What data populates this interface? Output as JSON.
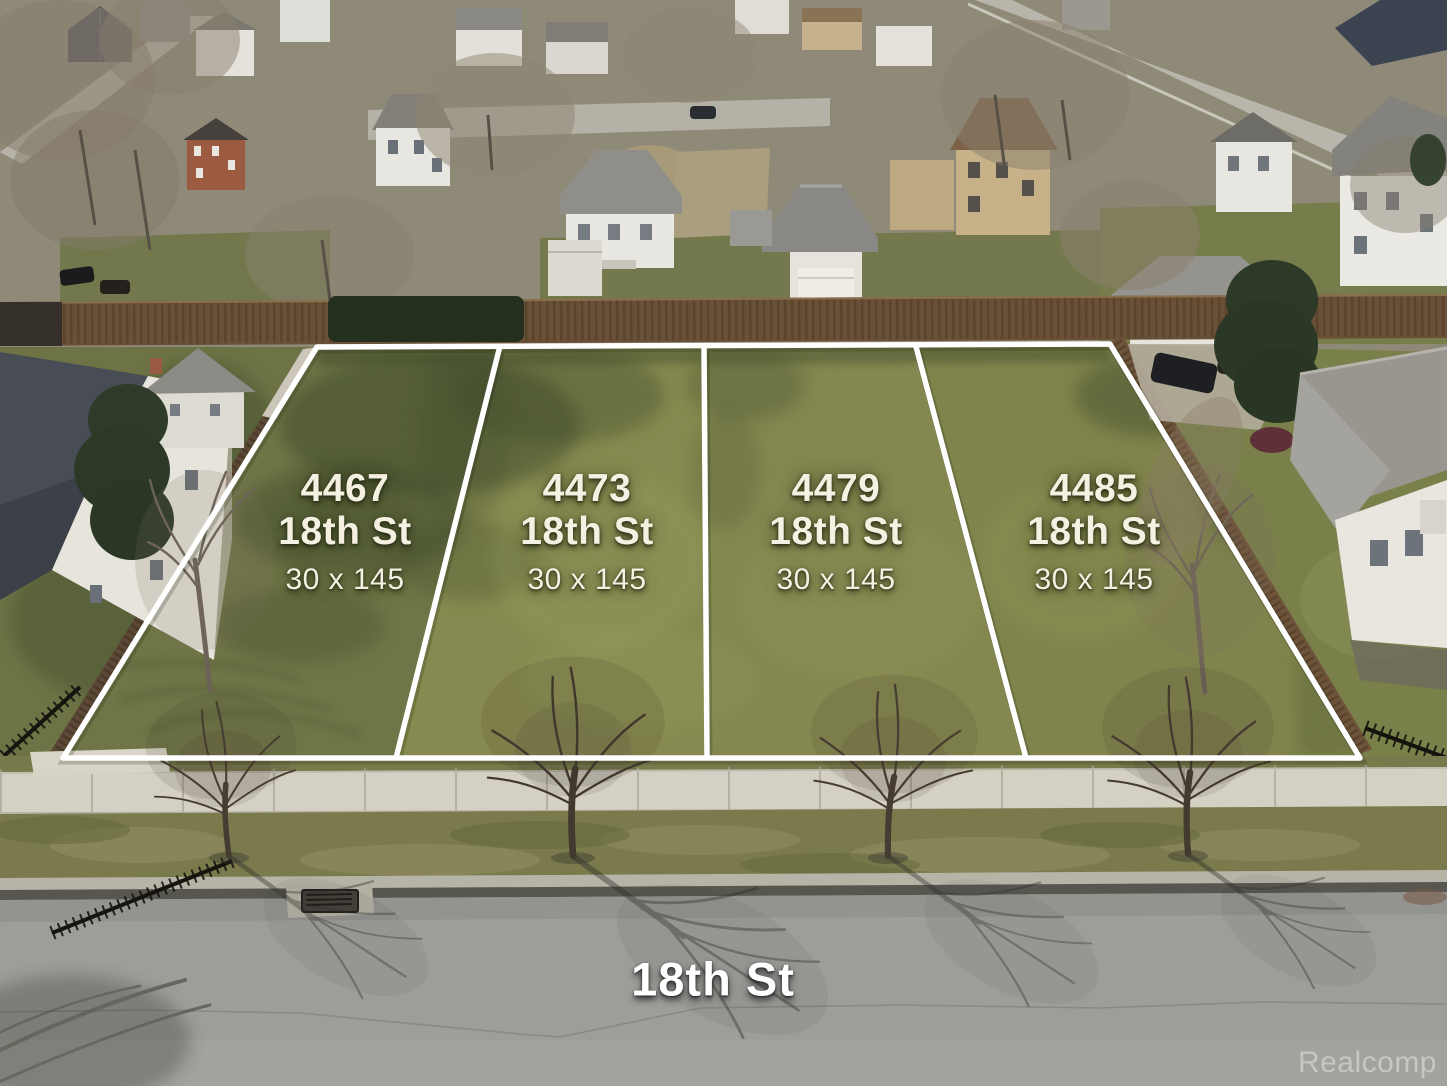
{
  "photo": {
    "type": "aerial-drone-photo",
    "street_label": "18th St",
    "watermark": "Realcomp",
    "lots": [
      {
        "address": "4467",
        "street": "18th St",
        "dimensions": "30 x 145"
      },
      {
        "address": "4473",
        "street": "18th St",
        "dimensions": "30 x 145"
      },
      {
        "address": "4479",
        "street": "18th St",
        "dimensions": "30 x 145"
      },
      {
        "address": "4485",
        "street": "18th St",
        "dimensions": "30 x 145"
      }
    ],
    "colors": {
      "boundary_line": "#ffffff",
      "lot_label_text": "#f5f1e2",
      "street_label_text": "#ffffff",
      "watermark_text": "#d9d9d5"
    }
  }
}
